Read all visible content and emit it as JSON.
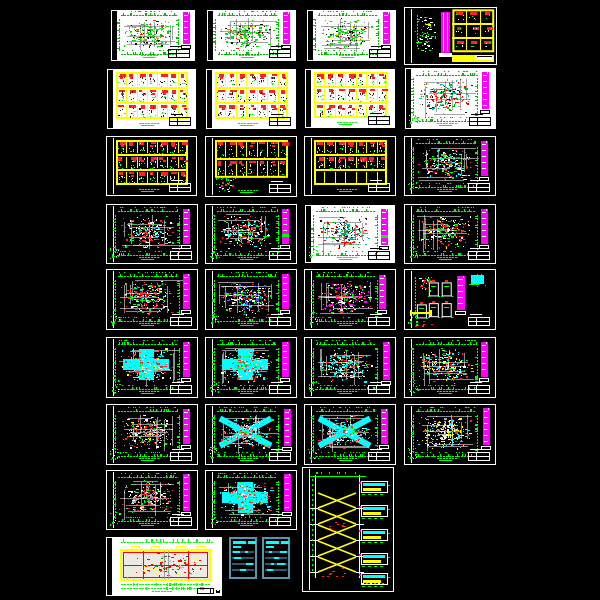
{
  "app": {
    "kind": "cad-sheet-preview-grid",
    "background": "#000000",
    "canvas_size": {
      "width": 600,
      "height": 600
    },
    "sheet_count": 33
  },
  "colors": {
    "magenta": "#ff00ff",
    "green": "#00ff00",
    "red": "#ff2222",
    "yellow": "#ffff00",
    "cyan": "#00ffff",
    "white": "#ffffff",
    "gray": "#aaaaaa",
    "blue": "#4455ff",
    "table_border": "#5b93ad",
    "table_row": "#2a5a6e",
    "paper_white": "#ffffff",
    "paper_black": "#000000"
  },
  "palettes": {
    "greenPlan": [
      [
        "#00dd00",
        0.5
      ],
      [
        "#111111",
        0.2
      ],
      [
        "#ff2222",
        0.08
      ],
      [
        "#ffff00",
        0.06
      ],
      [
        "#888888",
        0.16
      ]
    ],
    "cyanRedOnWhite": [
      [
        "#ff0000",
        0.26
      ],
      [
        "#00bbbb",
        0.22
      ],
      [
        "#00bb00",
        0.16
      ],
      [
        "#111111",
        0.2
      ],
      [
        "#999999",
        0.16
      ]
    ],
    "whiteRedGreen": [
      [
        "#ffffff",
        0.32
      ],
      [
        "#ff2222",
        0.3
      ],
      [
        "#00ff00",
        0.22
      ],
      [
        "#00ffff",
        0.16
      ]
    ],
    "redGreen": [
      [
        "#ff2222",
        0.34
      ],
      [
        "#00ff00",
        0.3
      ],
      [
        "#ffffff",
        0.26
      ],
      [
        "#ffff00",
        0.1
      ]
    ],
    "redWhiteDense": [
      [
        "#ff2222",
        0.36
      ],
      [
        "#ffffff",
        0.3
      ],
      [
        "#00ff00",
        0.2
      ],
      [
        "#00ffff",
        0.14
      ]
    ],
    "redBlueWhite": [
      [
        "#ff2222",
        0.3
      ],
      [
        "#ffffff",
        0.3
      ],
      [
        "#4455ff",
        0.16
      ],
      [
        "#00ff00",
        0.14
      ],
      [
        "#00ffff",
        0.1
      ]
    ],
    "magentaRedWhite": [
      [
        "#ff00ff",
        0.24
      ],
      [
        "#ffffff",
        0.3
      ],
      [
        "#ff2222",
        0.26
      ],
      [
        "#00ff00",
        0.2
      ]
    ],
    "cyanYellowRed": [
      [
        "#00ffff",
        0.3
      ],
      [
        "#ffff00",
        0.16
      ],
      [
        "#ff2222",
        0.24
      ],
      [
        "#ffffff",
        0.2
      ],
      [
        "#00ff00",
        0.1
      ]
    ],
    "cyanRed": [
      [
        "#00ffff",
        0.36
      ],
      [
        "#ff2222",
        0.26
      ],
      [
        "#ffffff",
        0.24
      ],
      [
        "#00ff00",
        0.14
      ]
    ],
    "redYellowCyan": [
      [
        "#ff2222",
        0.3
      ],
      [
        "#ffff00",
        0.2
      ],
      [
        "#00ffff",
        0.2
      ],
      [
        "#ffffff",
        0.2
      ],
      [
        "#00ff00",
        0.1
      ]
    ],
    "grayRedYellow": [
      [
        "#aaaaaa",
        0.3
      ],
      [
        "#ff2222",
        0.26
      ],
      [
        "#ffff00",
        0.14
      ],
      [
        "#ffffff",
        0.2
      ],
      [
        "#00ff00",
        0.1
      ]
    ],
    "cyanGrayRed": [
      [
        "#00ffff",
        0.3
      ],
      [
        "#aaaaaa",
        0.2
      ],
      [
        "#ff2222",
        0.2
      ],
      [
        "#ffffff",
        0.2
      ],
      [
        "#00ff00",
        0.1
      ]
    ],
    "yellowCyanGray": [
      [
        "#ffff00",
        0.26
      ],
      [
        "#00ffff",
        0.24
      ],
      [
        "#aaaaaa",
        0.2
      ],
      [
        "#ffffff",
        0.2
      ],
      [
        "#ff2222",
        0.1
      ]
    ],
    "grayRed": [
      [
        "#aaaaaa",
        0.3
      ],
      [
        "#ff2222",
        0.3
      ],
      [
        "#ffffff",
        0.26
      ],
      [
        "#00ff00",
        0.14
      ]
    ],
    "cyanRedGreen": [
      [
        "#00ffff",
        0.26
      ],
      [
        "#ff2222",
        0.26
      ],
      [
        "#00ff00",
        0.26
      ],
      [
        "#ffffff",
        0.22
      ]
    ]
  },
  "sheets": [
    {
      "name": "sheet-r1c1-plan-green",
      "x": 110,
      "y": 9,
      "w": 86,
      "h": 53,
      "bg": "white",
      "type": "plan",
      "palette": "greenPlan",
      "density": 190,
      "corner": false,
      "bar": {
        "x": 0.85,
        "y": 0.05,
        "h": 0.6
      }
    },
    {
      "name": "sheet-r1c2-plan-green",
      "x": 206,
      "y": 9,
      "w": 91,
      "h": 53,
      "bg": "white",
      "type": "plan",
      "palette": "greenPlan",
      "density": 200,
      "corner": false,
      "bar": {
        "x": 0.85,
        "y": 0.05,
        "h": 0.6
      }
    },
    {
      "name": "sheet-r1c3-plan-green",
      "x": 306,
      "y": 9,
      "w": 91,
      "h": 53,
      "bg": "white",
      "type": "plan",
      "palette": "greenPlan",
      "density": 200,
      "corner": false,
      "bar": {
        "x": 0.85,
        "y": 0.05,
        "h": 0.6
      }
    },
    {
      "name": "sheet-r1c4-column-details-grid",
      "x": 404,
      "y": 7,
      "w": 93,
      "h": 58,
      "bg": "black",
      "type": "mixed"
    },
    {
      "name": "sheet-r2c1-detail-grid",
      "x": 106,
      "y": 68,
      "w": 91,
      "h": 62,
      "bg": "white",
      "type": "grid",
      "contentRows": 3,
      "totalRows": 3,
      "ncols": 7
    },
    {
      "name": "sheet-r2c2-detail-grid",
      "x": 205,
      "y": 68,
      "w": 92,
      "h": 62,
      "bg": "white",
      "type": "grid",
      "contentRows": 3,
      "totalRows": 3,
      "ncols": 7
    },
    {
      "name": "sheet-r2c3-detail-grid",
      "x": 304,
      "y": 68,
      "w": 92,
      "h": 61,
      "bg": "white",
      "type": "grid",
      "contentRows": 3,
      "totalRows": 3,
      "ncols": 7
    },
    {
      "name": "sheet-r2c4-plan-cyan-red",
      "x": 404,
      "y": 67,
      "w": 93,
      "h": 63,
      "bg": "white",
      "type": "plan",
      "palette": "cyanRedOnWhite",
      "density": 220,
      "corner": true,
      "bar": {
        "x": 0.84,
        "y": 0.08,
        "h": 0.58
      }
    },
    {
      "name": "sheet-r3c1-detail-grid",
      "x": 106,
      "y": 136,
      "w": 91,
      "h": 60,
      "bg": "black",
      "type": "grid",
      "contentRows": 3,
      "totalRows": 3,
      "ncols": 7
    },
    {
      "name": "sheet-r3c2-detail-grid-partial",
      "x": 205,
      "y": 136,
      "w": 92,
      "h": 61,
      "bg": "black",
      "type": "grid",
      "contentRows": 2,
      "totalRows": 2,
      "ncols": 7,
      "tableH": 0.62,
      "figure": true
    },
    {
      "name": "sheet-r3c3-detail-grid-empty-row",
      "x": 304,
      "y": 136,
      "w": 92,
      "h": 60,
      "bg": "black",
      "type": "grid",
      "contentRows": 2,
      "totalRows": 3,
      "ncols": 7
    },
    {
      "name": "sheet-r3c4-plan-cyan-red-green",
      "x": 404,
      "y": 136,
      "w": 92,
      "h": 60,
      "bg": "black",
      "type": "plan",
      "palette": "cyanRedGreen",
      "density": 220,
      "corner": true,
      "bar": {
        "x": 0.84,
        "y": 0.08,
        "h": 0.58
      }
    },
    {
      "name": "sheet-r4c1-plan",
      "x": 106,
      "y": 204,
      "w": 92,
      "h": 60,
      "bg": "black",
      "type": "plan",
      "palette": "whiteRedGreen",
      "density": 230,
      "corner": true,
      "bar": {
        "x": 0.84,
        "y": 0.08,
        "h": 0.58
      }
    },
    {
      "name": "sheet-r4c2-plan",
      "x": 205,
      "y": 204,
      "w": 92,
      "h": 60,
      "bg": "black",
      "type": "plan",
      "palette": "whiteRedGreen",
      "density": 230,
      "corner": true,
      "bar": {
        "x": 0.84,
        "y": 0.08,
        "h": 0.58,
        "greenStripe": true
      }
    },
    {
      "name": "sheet-r4c3-plan-white",
      "x": 304,
      "y": 204,
      "w": 92,
      "h": 60,
      "bg": "white",
      "type": "plan",
      "palette": "cyanRedOnWhite",
      "density": 230,
      "corner": true,
      "bar": {
        "x": 0.84,
        "y": 0.08,
        "h": 0.6,
        "greenStripe": true
      }
    },
    {
      "name": "sheet-r4c4-plan",
      "x": 404,
      "y": 204,
      "w": 92,
      "h": 60,
      "bg": "black",
      "type": "plan",
      "palette": "redGreen",
      "density": 220,
      "corner": true,
      "bar": {
        "x": 0.84,
        "y": 0.08,
        "h": 0.58
      }
    },
    {
      "name": "sheet-r5c1-plan",
      "x": 106,
      "y": 269,
      "w": 92,
      "h": 61,
      "bg": "black",
      "type": "plan",
      "palette": "redWhiteDense",
      "density": 250,
      "corner": true,
      "bar": {
        "x": 0.84,
        "y": 0.08,
        "h": 0.58
      }
    },
    {
      "name": "sheet-r5c2-plan",
      "x": 205,
      "y": 269,
      "w": 92,
      "h": 61,
      "bg": "black",
      "type": "plan",
      "palette": "redBlueWhite",
      "density": 240,
      "corner": true,
      "bar": {
        "x": 0.84,
        "y": 0.08,
        "h": 0.58
      }
    },
    {
      "name": "sheet-r5c3-plan",
      "x": 304,
      "y": 269,
      "w": 92,
      "h": 61,
      "bg": "black",
      "type": "plan",
      "palette": "magentaRedWhite",
      "density": 220,
      "corner": true,
      "bar": {
        "x": 0.82,
        "y": 0.1,
        "h": 0.55
      }
    },
    {
      "name": "sheet-r5c4-section-details",
      "x": 404,
      "y": 269,
      "w": 92,
      "h": 61,
      "bg": "black",
      "type": "details"
    },
    {
      "name": "sheet-r6c1-plan",
      "x": 106,
      "y": 337,
      "w": 92,
      "h": 61,
      "bg": "black",
      "type": "plan",
      "palette": "cyanYellowRed",
      "density": 240,
      "corner": true,
      "motif": "plus",
      "bar": {
        "x": 0.84,
        "y": 0.08,
        "h": 0.58
      }
    },
    {
      "name": "sheet-r6c2-plan-cyan-cross",
      "x": 205,
      "y": 337,
      "w": 92,
      "h": 61,
      "bg": "black",
      "type": "plan",
      "palette": "cyanRed",
      "density": 220,
      "corner": true,
      "motif": "plus",
      "bar": {
        "x": 0.84,
        "y": 0.08,
        "h": 0.58
      }
    },
    {
      "name": "sheet-r6c3-plan",
      "x": 304,
      "y": 337,
      "w": 92,
      "h": 61,
      "bg": "black",
      "type": "plan",
      "palette": "cyanRed",
      "density": 260,
      "corner": true,
      "bar": {
        "x": 0.86,
        "y": 0.08,
        "h": 0.62
      }
    },
    {
      "name": "sheet-r6c4-plan",
      "x": 404,
      "y": 337,
      "w": 92,
      "h": 61,
      "bg": "black",
      "type": "plan",
      "palette": "redYellowCyan",
      "density": 240,
      "corner": true,
      "bar": {
        "x": 0.84,
        "y": 0.08,
        "h": 0.58
      }
    },
    {
      "name": "sheet-r7c1-plan",
      "x": 106,
      "y": 404,
      "w": 92,
      "h": 61,
      "bg": "black",
      "type": "plan",
      "palette": "grayRedYellow",
      "density": 250,
      "corner": true,
      "bar": {
        "x": 0.84,
        "y": 0.08,
        "h": 0.58
      }
    },
    {
      "name": "sheet-r7c2-plan-cyan-x",
      "x": 205,
      "y": 404,
      "w": 92,
      "h": 61,
      "bg": "black",
      "type": "plan",
      "palette": "cyanGrayRed",
      "density": 230,
      "corner": true,
      "motif": "x",
      "bar": {
        "x": 0.86,
        "y": 0.08,
        "h": 0.6
      }
    },
    {
      "name": "sheet-r7c3-plan",
      "x": 304,
      "y": 404,
      "w": 92,
      "h": 61,
      "bg": "black",
      "type": "plan",
      "palette": "cyanGrayRed",
      "density": 250,
      "corner": true,
      "motif": "x",
      "bar": {
        "x": 0.84,
        "y": 0.08,
        "h": 0.58
      }
    },
    {
      "name": "sheet-r7c4-plan",
      "x": 404,
      "y": 404,
      "w": 92,
      "h": 61,
      "bg": "black",
      "type": "plan",
      "palette": "yellowCyanGray",
      "density": 250,
      "corner": true,
      "bar": {
        "x": 0.86,
        "y": 0.06,
        "h": 0.6
      }
    },
    {
      "name": "sheet-r8c1-plan",
      "x": 106,
      "y": 470,
      "w": 92,
      "h": 60,
      "bg": "black",
      "type": "plan",
      "palette": "grayRed",
      "density": 240,
      "corner": true,
      "bar": {
        "x": 0.84,
        "y": 0.06,
        "h": 0.62
      }
    },
    {
      "name": "sheet-r8c2-plan",
      "x": 205,
      "y": 470,
      "w": 92,
      "h": 60,
      "bg": "black",
      "type": "plan",
      "palette": "cyanRed",
      "density": 250,
      "corner": true,
      "motif": "plus",
      "bar": {
        "x": 0.86,
        "y": 0.06,
        "h": 0.62
      }
    },
    {
      "name": "sheet-stair-section",
      "x": 302,
      "y": 467,
      "w": 92,
      "h": 125,
      "bg": "black",
      "type": "stair"
    },
    {
      "name": "sheet-architectural-plan-wide",
      "x": 105,
      "y": 536,
      "w": 118,
      "h": 61,
      "bg": "white",
      "type": "archplan"
    },
    {
      "name": "sheet-notes-tables",
      "x": 228,
      "y": 536,
      "w": 63,
      "h": 46,
      "bg": "black",
      "type": "tables",
      "frameless": true
    }
  ]
}
